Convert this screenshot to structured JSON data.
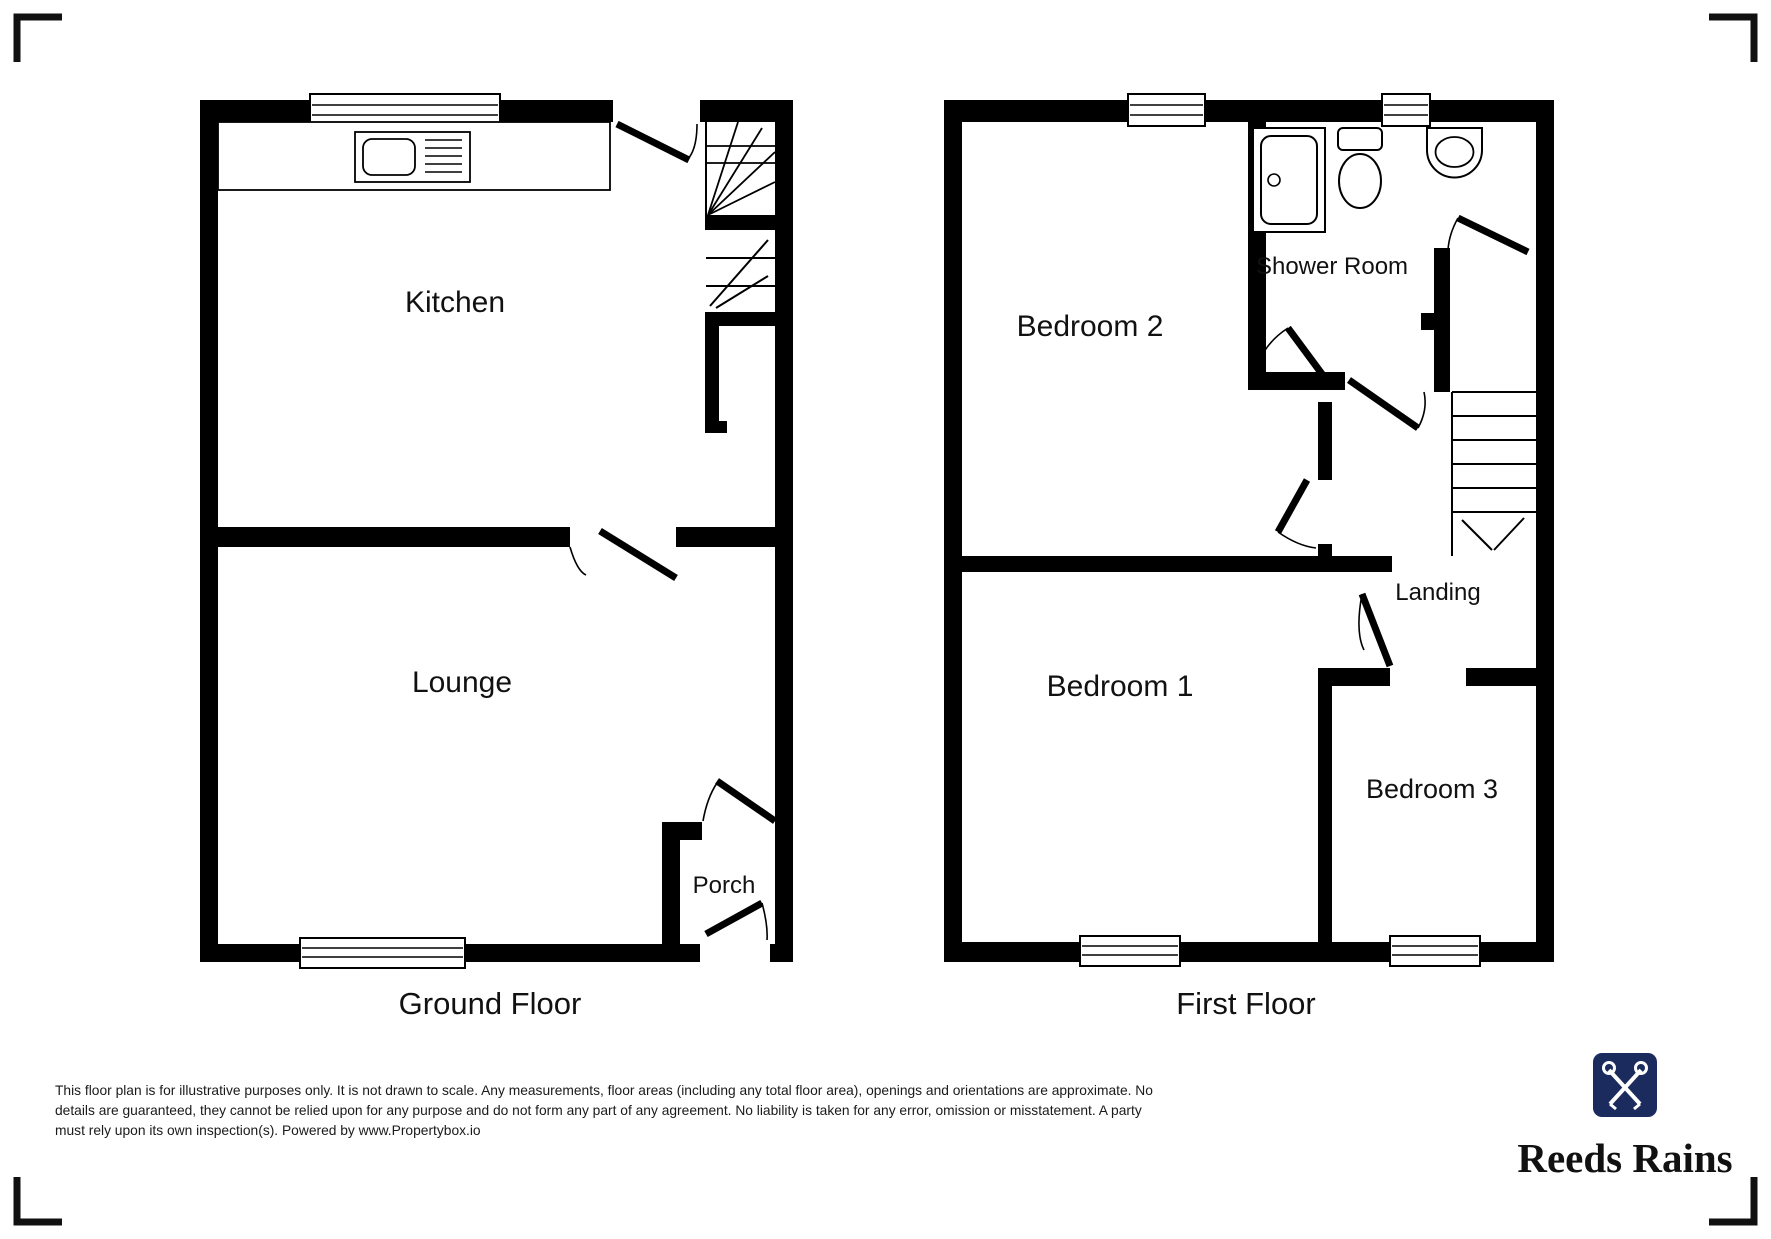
{
  "colors": {
    "wall": "#000000",
    "line": "#000000",
    "brand_navy": "#1b2b5e",
    "text": "#111111"
  },
  "ground_floor": {
    "caption": "Ground Floor",
    "rooms": {
      "kitchen": "Kitchen",
      "lounge": "Lounge",
      "porch": "Porch"
    },
    "icons": [
      "sink-icon",
      "stairs-icon",
      "window-icon",
      "door-swing-icon"
    ]
  },
  "first_floor": {
    "caption": "First Floor",
    "rooms": {
      "bedroom2": "Bedroom 2",
      "shower_room": "Shower Room",
      "landing": "Landing",
      "bedroom1": "Bedroom 1",
      "bedroom3": "Bedroom 3"
    },
    "icons": [
      "shower-tray-icon",
      "toilet-icon",
      "basin-icon",
      "stairs-icon",
      "window-icon",
      "door-swing-icon"
    ]
  },
  "disclaimer": {
    "line1": "This floor plan is for illustrative purposes only. It is not drawn to scale. Any measurements, floor areas (including any total floor area), openings and orientations are approximate. No",
    "line2": "details are guaranteed, they cannot be relied upon for any purpose and do not form any part of any agreement. No liability is taken for any error, omission or misstatement. A party",
    "line3": "must rely upon its own inspection(s). Powered by www.Propertybox.io"
  },
  "logo": {
    "brand": "Reeds Rains"
  }
}
